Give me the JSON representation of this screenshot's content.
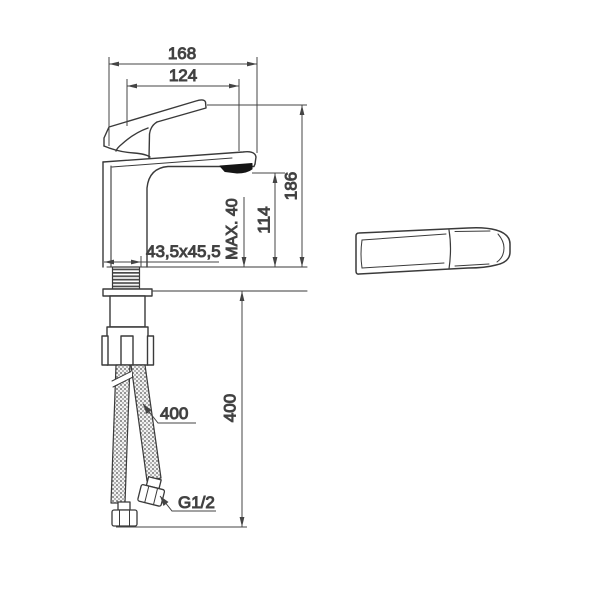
{
  "drawing": {
    "dims": {
      "overall_length": "168",
      "spout_projection": "124",
      "overall_height": "186",
      "spout_height": "114",
      "max_mounting_thickness": "MAX. 40",
      "base_footprint": "43,5x45,5",
      "hose_callout": "400",
      "hose_length": "400",
      "connection_thread": "G1/2"
    },
    "colors": {
      "line": "#3a3a3a",
      "dimension_line": "#444444",
      "text": "#3c3c3c",
      "background": "#ffffff",
      "aerator_fill": "#151515",
      "hose_texture": "#6f6f6f"
    }
  }
}
